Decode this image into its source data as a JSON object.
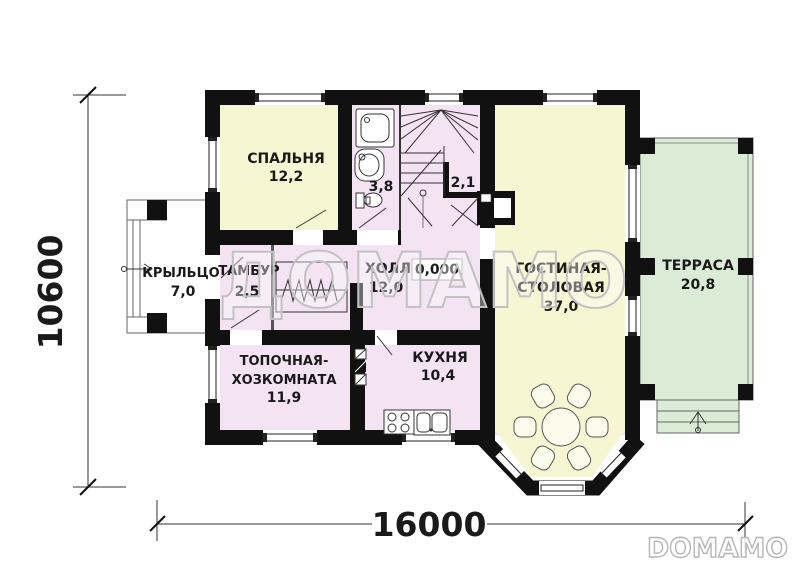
{
  "plan": {
    "watermark_center": "ДОМАМО",
    "brand_logo": "DOMAMO",
    "elevation_mark": "0,000"
  },
  "dimensions": {
    "overall_width": "16000",
    "overall_height": "10600"
  },
  "rooms": {
    "bedroom": {
      "label": "СПАЛЬНЯ",
      "area": "12,2"
    },
    "bathroom": {
      "area": "3,8"
    },
    "stair_storage": {
      "area": "2,1"
    },
    "porch": {
      "label": "КРЫЛЬЦО",
      "area": "7,0"
    },
    "vestibule": {
      "label": "ТАМБУР",
      "area": "2,5"
    },
    "hall": {
      "label": "ХОЛЛ",
      "area": "12,0"
    },
    "living_dining": {
      "label_line1": "ГОСТИНАЯ-",
      "label_line2": "СТОЛОВАЯ",
      "area": "37,0"
    },
    "terrace": {
      "label": "ТЕРРАСА",
      "area": "20,8"
    },
    "boiler_utility": {
      "label_line1": "ТОПОЧНАЯ-",
      "label_line2": "ХОЗКОМНАТА",
      "area": "11,9"
    },
    "kitchen": {
      "label": "КУХНЯ",
      "area": "10,4"
    }
  },
  "colors": {
    "wall": "#111111",
    "room_living": "#f6f6d2",
    "room_service": "#f3e3f3",
    "outdoor": "#daecd6",
    "watermark": "#c2c2c2"
  }
}
